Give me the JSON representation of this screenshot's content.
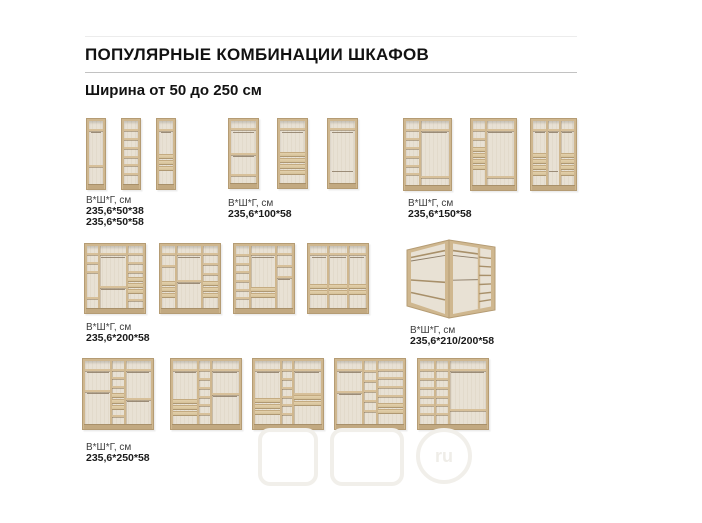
{
  "page": {
    "title": "ПОПУЛЯРНЫЕ КОМБИНАЦИИ ШКАФОВ",
    "subtitle": "Ширина от 50 до 250 см"
  },
  "watermark": {
    "text": "ru"
  },
  "colors": {
    "wood": "#cfb78f",
    "wood_edge": "#b59c74",
    "interior": "#e8e1d4",
    "shelf": "#d7c09a",
    "rod": "#8d7d67",
    "drawer": "#dcc8a2",
    "rule": "#c2c2c2"
  },
  "groups": [
    {
      "name": "width-50",
      "dims": "В*Ш*Г, см",
      "sizes": [
        "235,6*50*38",
        "235,6*50*58"
      ],
      "label_pos": {
        "x": 86,
        "y": 195
      },
      "units": [
        {
          "x": 86,
          "y": 118,
          "w": 20,
          "h": 72,
          "cols": [
            {
              "w": 1,
              "shelves": [
                0.12,
                0.7
              ],
              "rods": [
                0.17
              ]
            }
          ]
        },
        {
          "x": 121,
          "y": 118,
          "w": 20,
          "h": 72,
          "cols": [
            {
              "w": 1,
              "shelves": [
                0.13,
                0.27,
                0.41,
                0.55,
                0.69,
                0.83
              ]
            }
          ]
        },
        {
          "x": 156,
          "y": 118,
          "w": 20,
          "h": 72,
          "cols": [
            {
              "w": 1,
              "shelves": [
                0.12
              ],
              "rods": [
                0.17
              ],
              "drawers": {
                "top": 0.52,
                "count": 3,
                "h": 0.095
              }
            }
          ]
        }
      ]
    },
    {
      "name": "width-100",
      "dims": "В*Ш*Г, см",
      "sizes": [
        "235,6*100*58"
      ],
      "label_pos": {
        "x": 228,
        "y": 198
      },
      "units": [
        {
          "x": 228,
          "y": 118,
          "w": 31,
          "h": 71,
          "cols": [
            {
              "w": 1,
              "shelves": [
                0.12,
                0.52,
                0.86
              ],
              "rods": [
                0.17,
                0.57
              ]
            }
          ]
        },
        {
          "x": 277,
          "y": 118,
          "w": 31,
          "h": 71,
          "cols": [
            {
              "w": 1,
              "shelves": [
                0.12
              ],
              "rods": [
                0.17
              ],
              "drawers": {
                "top": 0.5,
                "count": 4,
                "h": 0.095
              }
            }
          ]
        },
        {
          "x": 327,
          "y": 118,
          "w": 31,
          "h": 71,
          "cols": [
            {
              "w": 1,
              "shelves": [
                0.12
              ],
              "rods": [
                0.17,
                0.8
              ]
            }
          ]
        }
      ]
    },
    {
      "name": "width-150",
      "dims": "В*Ш*Г, см",
      "sizes": [
        "235,6*150*58"
      ],
      "label_pos": {
        "x": 408,
        "y": 198
      },
      "units": [
        {
          "x": 403,
          "y": 118,
          "w": 49,
          "h": 73,
          "cols": [
            {
              "w": 0.32,
              "shelves": [
                0.12,
                0.26,
                0.4,
                0.54,
                0.68,
                0.82
              ]
            },
            {
              "w": 0.68,
              "shelves": [
                0.12,
                0.86
              ],
              "rods": [
                0.17
              ]
            }
          ]
        },
        {
          "x": 470,
          "y": 118,
          "w": 47,
          "h": 73,
          "cols": [
            {
              "w": 0.32,
              "shelves": [
                0.12,
                0.26
              ],
              "drawers": {
                "top": 0.4,
                "count": 4,
                "h": 0.09
              }
            },
            {
              "w": 0.68,
              "shelves": [
                0.12,
                0.86
              ],
              "rods": [
                0.17
              ]
            }
          ]
        },
        {
          "x": 530,
          "y": 118,
          "w": 47,
          "h": 73,
          "cols": [
            {
              "w": 0.33,
              "shelves": [
                0.12
              ],
              "rods": [
                0.17
              ],
              "drawers": {
                "top": 0.5,
                "count": 4,
                "h": 0.088
              }
            },
            {
              "w": 0.34,
              "shelves": [
                0.12
              ],
              "rods": [
                0.17,
                0.78
              ]
            },
            {
              "w": 0.33,
              "shelves": [
                0.12
              ],
              "rods": [
                0.17
              ],
              "drawers": {
                "top": 0.5,
                "count": 4,
                "h": 0.088
              }
            }
          ]
        }
      ]
    },
    {
      "name": "width-200",
      "dims": "В*Ш*Г, см",
      "sizes": [
        "235,6*200*58"
      ],
      "label_pos": {
        "x": 86,
        "y": 322
      },
      "units": [
        {
          "x": 84,
          "y": 243,
          "w": 62,
          "h": 71,
          "cols": [
            {
              "w": 0.22,
              "shelves": [
                0.12,
                0.26,
                0.4,
                0.82
              ]
            },
            {
              "w": 0.5,
              "shelves": [
                0.12,
                0.64
              ],
              "rods": [
                0.17,
                0.69
              ]
            },
            {
              "w": 0.28,
              "shelves": [
                0.12,
                0.26,
                0.4,
                0.86
              ],
              "drawers": {
                "top": 0.5,
                "count": 3,
                "h": 0.09
              }
            }
          ]
        },
        {
          "x": 159,
          "y": 243,
          "w": 62,
          "h": 71,
          "cols": [
            {
              "w": 0.25,
              "shelves": [
                0.12,
                0.3
              ],
              "drawers": {
                "top": 0.56,
                "count": 3,
                "h": 0.09
              }
            },
            {
              "w": 0.47,
              "shelves": [
                0.12,
                0.55
              ],
              "rods": [
                0.17,
                0.6
              ]
            },
            {
              "w": 0.28,
              "shelves": [
                0.12,
                0.28,
                0.44
              ],
              "drawers": {
                "top": 0.56,
                "count": 3,
                "h": 0.09
              }
            }
          ]
        },
        {
          "x": 233,
          "y": 243,
          "w": 62,
          "h": 71,
          "cols": [
            {
              "w": 0.25,
              "shelves": [
                0.13,
                0.27,
                0.41,
                0.55,
                0.69,
                0.83
              ]
            },
            {
              "w": 0.47,
              "shelves": [
                0.12
              ],
              "rods": [
                0.17
              ],
              "drawers": {
                "top": 0.66,
                "count": 2,
                "h": 0.09
              }
            },
            {
              "w": 0.28,
              "shelves": [
                0.12,
                0.3,
                0.48
              ],
              "rods": [
                0.53
              ]
            }
          ]
        },
        {
          "x": 307,
          "y": 243,
          "w": 62,
          "h": 71,
          "cols": [
            {
              "w": 0.33,
              "shelves": [
                0.12
              ],
              "rods": [
                0.17
              ],
              "drawers": {
                "top": 0.62,
                "count": 2,
                "h": 0.09
              }
            },
            {
              "w": 0.34,
              "shelves": [
                0.12
              ],
              "rods": [
                0.17
              ],
              "drawers": {
                "top": 0.62,
                "count": 2,
                "h": 0.09
              }
            },
            {
              "w": 0.33,
              "shelves": [
                0.12
              ],
              "rods": [
                0.17
              ],
              "drawers": {
                "top": 0.62,
                "count": 2,
                "h": 0.09
              }
            }
          ]
        }
      ]
    },
    {
      "name": "corner-210-200",
      "dims": "В*Ш*Г, см",
      "sizes": [
        "235,6*210/200*58"
      ],
      "label_pos": {
        "x": 410,
        "y": 325
      },
      "units": [
        {
          "corner": true,
          "x": 405,
          "y": 238,
          "w": 92,
          "h": 82
        }
      ]
    },
    {
      "name": "width-250",
      "dims": "В*Ш*Г, см",
      "sizes": [
        "235,6*250*58"
      ],
      "label_pos": {
        "x": 86,
        "y": 442
      },
      "units": [
        {
          "x": 82,
          "y": 358,
          "w": 72,
          "h": 72,
          "cols": [
            {
              "w": 0.4,
              "shelves": [
                0.12,
                0.46
              ],
              "rods": [
                0.17,
                0.51
              ]
            },
            {
              "w": 0.2,
              "shelves": [
                0.12,
                0.26,
                0.4,
                0.86
              ],
              "drawers": {
                "top": 0.5,
                "count": 3,
                "h": 0.09
              }
            },
            {
              "w": 0.4,
              "shelves": [
                0.12,
                0.58
              ],
              "rods": [
                0.17,
                0.63
              ]
            }
          ]
        },
        {
          "x": 170,
          "y": 358,
          "w": 72,
          "h": 72,
          "cols": [
            {
              "w": 0.38,
              "shelves": [
                0.12
              ],
              "rods": [
                0.17
              ],
              "drawers": {
                "top": 0.6,
                "count": 3,
                "h": 0.088
              }
            },
            {
              "w": 0.2,
              "shelves": [
                0.13,
                0.27,
                0.41,
                0.55,
                0.69,
                0.83
              ]
            },
            {
              "w": 0.42,
              "shelves": [
                0.12,
                0.5
              ],
              "rods": [
                0.17,
                0.55
              ]
            }
          ]
        },
        {
          "x": 252,
          "y": 358,
          "w": 72,
          "h": 72,
          "cols": [
            {
              "w": 0.4,
              "shelves": [
                0.12
              ],
              "rods": [
                0.17
              ],
              "drawers": {
                "top": 0.58,
                "count": 3,
                "h": 0.088
              }
            },
            {
              "w": 0.18,
              "shelves": [
                0.13,
                0.27,
                0.41,
                0.55,
                0.69,
                0.83
              ]
            },
            {
              "w": 0.42,
              "shelves": [
                0.12,
                0.5
              ],
              "rods": [
                0.17
              ],
              "drawers": {
                "top": 0.54,
                "count": 2,
                "h": 0.088
              }
            }
          ]
        },
        {
          "x": 334,
          "y": 358,
          "w": 72,
          "h": 72,
          "cols": [
            {
              "w": 0.4,
              "shelves": [
                0.12,
                0.48
              ],
              "rods": [
                0.17,
                0.53
              ]
            },
            {
              "w": 0.2,
              "shelves": [
                0.14,
                0.3,
                0.46,
                0.62,
                0.78
              ]
            },
            {
              "w": 0.4,
              "shelves": [
                0.12,
                0.26,
                0.4,
                0.54
              ],
              "drawers": {
                "top": 0.66,
                "count": 2,
                "h": 0.088
              }
            }
          ]
        },
        {
          "x": 417,
          "y": 358,
          "w": 72,
          "h": 72,
          "cols": [
            {
              "w": 0.22,
              "shelves": [
                0.13,
                0.27,
                0.41,
                0.55,
                0.69,
                0.83
              ]
            },
            {
              "w": 0.22,
              "shelves": [
                0.13,
                0.27,
                0.41,
                0.55,
                0.69,
                0.83
              ]
            },
            {
              "w": 0.56,
              "shelves": [
                0.12,
                0.76
              ],
              "rods": [
                0.17
              ]
            }
          ]
        }
      ]
    }
  ]
}
